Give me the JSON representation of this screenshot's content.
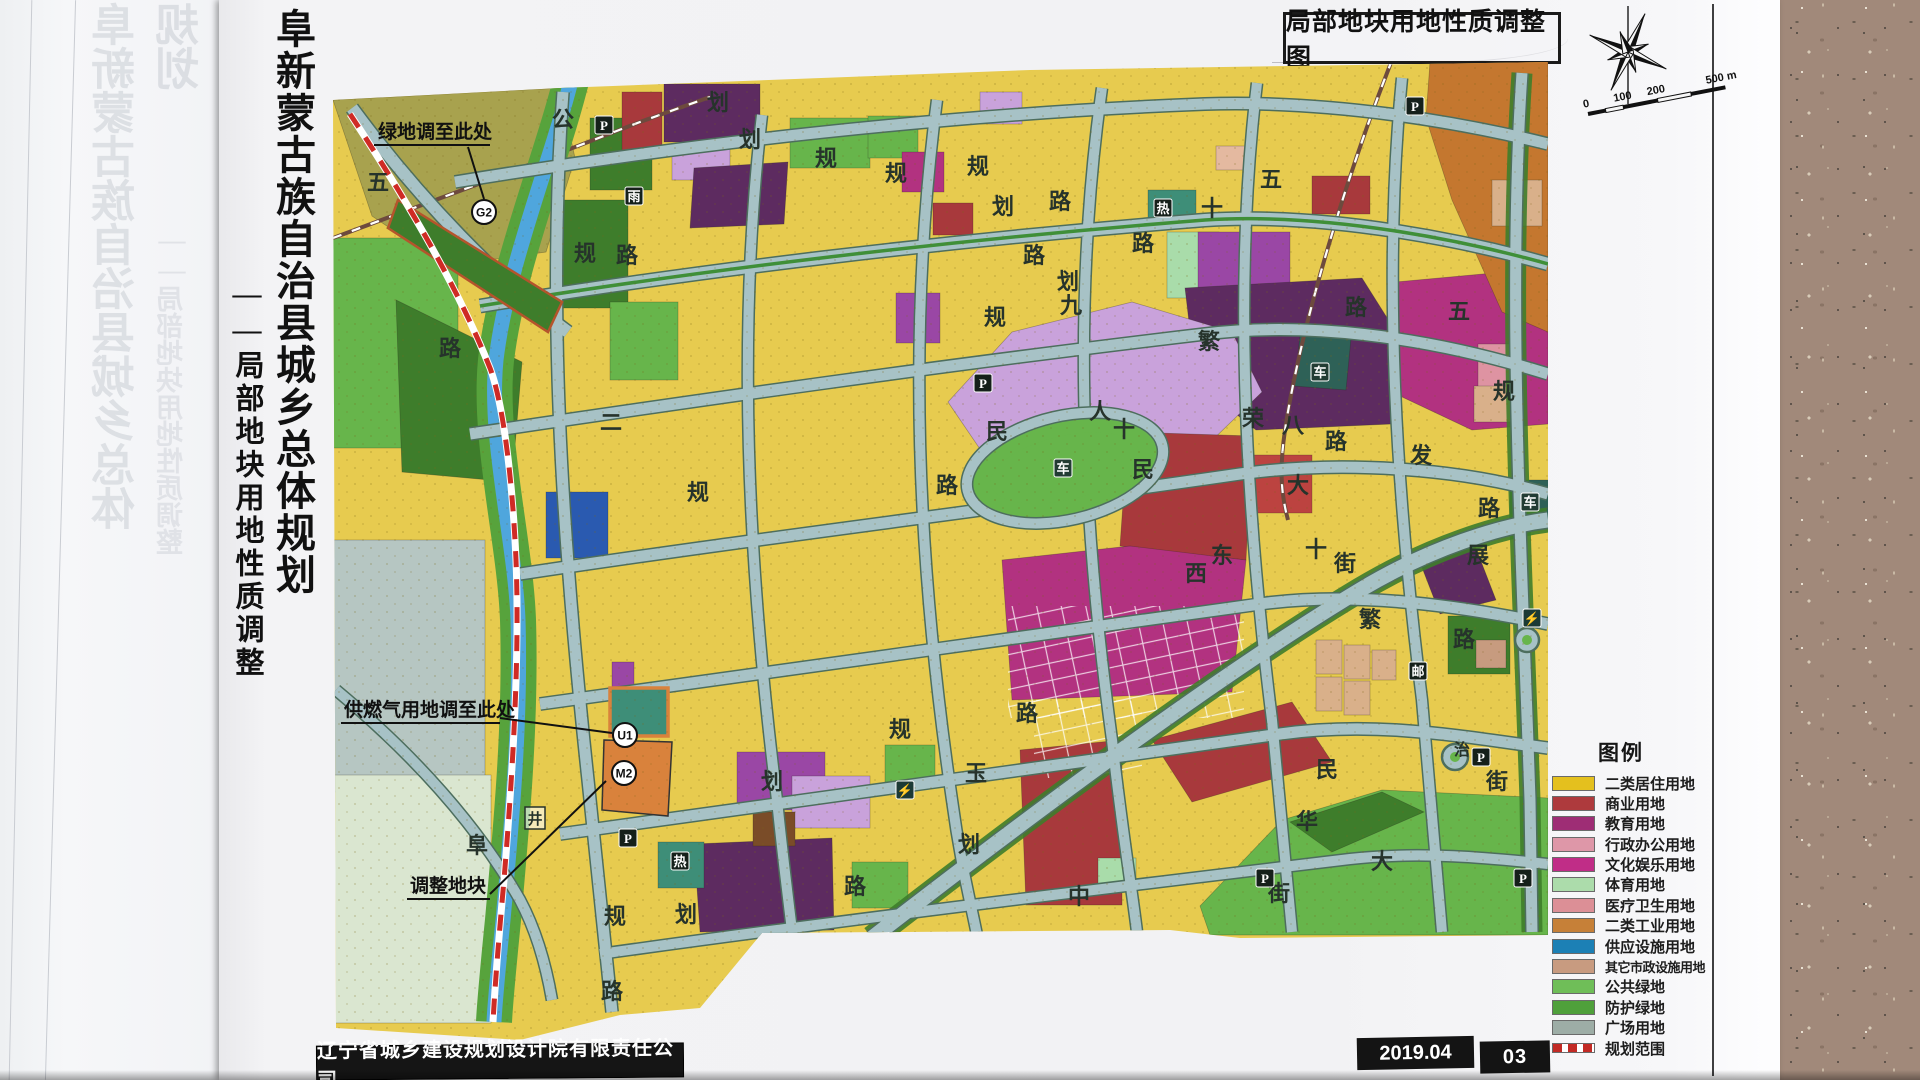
{
  "page": {
    "side_title_main": "阜新蒙古族自治县城乡总体规划",
    "side_title_sub": "——局部地块用地性质调整",
    "ghost_title_main": "阜新蒙古族自治县城乡总体规划",
    "ghost_title_sub": "——局部地块用地性质调整",
    "map_sheet_title": "局部地块用地性质调整图",
    "publisher": "辽宁省城乡建设规划设计院有限责任公司",
    "date": "2019.04",
    "page_number": "03"
  },
  "scale_bar": {
    "labels": [
      "0",
      "100",
      "200",
      "500 m"
    ]
  },
  "annotations": [
    {
      "text": "绿地调至此处",
      "badge": "G2"
    },
    {
      "text": "供燃气用地调至此处",
      "badge": "U1"
    },
    {
      "text": "调整地块",
      "badge": "M2"
    }
  ],
  "legend": {
    "title": "图例",
    "items": [
      {
        "label": "二类居住用地",
        "color": "#e4c01e"
      },
      {
        "label": "商业用地",
        "color": "#ae3a3d"
      },
      {
        "label": "教育用地",
        "color": "#9e2d75"
      },
      {
        "label": "行政办公用地",
        "color": "#de97a8"
      },
      {
        "label": "文化娱乐用地",
        "color": "#c02d87"
      },
      {
        "label": "体育用地",
        "color": "#acdcab"
      },
      {
        "label": "医疗卫生用地",
        "color": "#dc8f96"
      },
      {
        "label": "二类工业用地",
        "color": "#c68038"
      },
      {
        "label": "供应设施用地",
        "color": "#1c80b5"
      },
      {
        "label": "其它市政设施用地",
        "color": "#c89b80",
        "small": true
      },
      {
        "label": "公共绿地",
        "color": "#6fbe58"
      },
      {
        "label": "防护绿地",
        "color": "#4fa03b"
      },
      {
        "label": "广场用地",
        "color": "#9dada6"
      },
      {
        "label": "规划范围",
        "color": "boundary",
        "boundary": true
      }
    ]
  },
  "map": {
    "road_labels": [
      {
        "t": "公",
        "x": 563,
        "y": 127
      },
      {
        "t": "五",
        "x": 378,
        "y": 190
      },
      {
        "t": "路",
        "x": 450,
        "y": 356
      },
      {
        "t": "划",
        "x": 718,
        "y": 110
      },
      {
        "t": "划",
        "x": 750,
        "y": 147
      },
      {
        "t": "规",
        "x": 826,
        "y": 166
      },
      {
        "t": "规",
        "x": 896,
        "y": 181
      },
      {
        "t": "规",
        "x": 978,
        "y": 174
      },
      {
        "t": "划",
        "x": 1003,
        "y": 214
      },
      {
        "t": "路",
        "x": 1060,
        "y": 209
      },
      {
        "t": "规",
        "x": 585,
        "y": 261
      },
      {
        "t": "路",
        "x": 627,
        "y": 263
      },
      {
        "t": "二",
        "x": 611,
        "y": 430
      },
      {
        "t": "规",
        "x": 698,
        "y": 500
      },
      {
        "t": "路",
        "x": 1034,
        "y": 263
      },
      {
        "t": "划",
        "x": 1068,
        "y": 289
      },
      {
        "t": "九",
        "x": 1071,
        "y": 313
      },
      {
        "t": "路",
        "x": 1143,
        "y": 251
      },
      {
        "t": "规",
        "x": 995,
        "y": 325
      },
      {
        "t": "十",
        "x": 1212,
        "y": 216
      },
      {
        "t": "五",
        "x": 1271,
        "y": 187
      },
      {
        "t": "繁",
        "x": 1209,
        "y": 349
      },
      {
        "t": "荣",
        "x": 1253,
        "y": 426
      },
      {
        "t": "八",
        "x": 1293,
        "y": 433
      },
      {
        "t": "路",
        "x": 1336,
        "y": 449
      },
      {
        "t": "规",
        "x": 1504,
        "y": 399
      },
      {
        "t": "五",
        "x": 1459,
        "y": 319
      },
      {
        "t": "路",
        "x": 1356,
        "y": 315
      },
      {
        "t": "民",
        "x": 997,
        "y": 439
      },
      {
        "t": "人",
        "x": 1100,
        "y": 419
      },
      {
        "t": "十",
        "x": 1124,
        "y": 437
      },
      {
        "t": "民",
        "x": 1143,
        "y": 477
      },
      {
        "t": "路",
        "x": 947,
        "y": 493
      },
      {
        "t": "大",
        "x": 1298,
        "y": 493
      },
      {
        "t": "十",
        "x": 1316,
        "y": 557
      },
      {
        "t": "街",
        "x": 1345,
        "y": 571
      },
      {
        "t": "发",
        "x": 1421,
        "y": 463
      },
      {
        "t": "路",
        "x": 1489,
        "y": 516
      },
      {
        "t": "展",
        "x": 1478,
        "y": 563
      },
      {
        "t": "西",
        "x": 1196,
        "y": 581
      },
      {
        "t": "东",
        "x": 1222,
        "y": 563
      },
      {
        "t": "繁",
        "x": 1370,
        "y": 627
      },
      {
        "t": "路",
        "x": 1464,
        "y": 647
      },
      {
        "t": "治",
        "x": 1462,
        "y": 755,
        "s": 16
      },
      {
        "t": "街",
        "x": 1497,
        "y": 789
      },
      {
        "t": "民",
        "x": 1327,
        "y": 777
      },
      {
        "t": "华",
        "x": 1307,
        "y": 829
      },
      {
        "t": "大",
        "x": 1382,
        "y": 869
      },
      {
        "t": "规",
        "x": 900,
        "y": 737
      },
      {
        "t": "路",
        "x": 1027,
        "y": 721
      },
      {
        "t": "玉",
        "x": 976,
        "y": 781
      },
      {
        "t": "划",
        "x": 969,
        "y": 852
      },
      {
        "t": "路",
        "x": 855,
        "y": 894
      },
      {
        "t": "划",
        "x": 772,
        "y": 789
      },
      {
        "t": "中",
        "x": 1079,
        "y": 904
      },
      {
        "t": "街",
        "x": 1279,
        "y": 901
      },
      {
        "t": "规",
        "x": 615,
        "y": 924
      },
      {
        "t": "划",
        "x": 686,
        "y": 922
      },
      {
        "t": "阜",
        "x": 477,
        "y": 853
      },
      {
        "t": "路",
        "x": 612,
        "y": 999
      }
    ],
    "icons": [
      {
        "g": "P",
        "x": 604,
        "y": 125
      },
      {
        "g": "P",
        "x": 983,
        "y": 383
      },
      {
        "g": "P",
        "x": 628,
        "y": 838
      },
      {
        "g": "P",
        "x": 1265,
        "y": 878
      },
      {
        "g": "P",
        "x": 1523,
        "y": 878
      },
      {
        "g": "P",
        "x": 1481,
        "y": 757
      },
      {
        "g": "P",
        "x": 1415,
        "y": 106
      },
      {
        "g": "雨",
        "x": 634,
        "y": 196
      },
      {
        "g": "热",
        "x": 680,
        "y": 861
      },
      {
        "g": "热",
        "x": 1163,
        "y": 208
      },
      {
        "g": "邮",
        "x": 1418,
        "y": 671
      },
      {
        "g": "⚡",
        "x": 905,
        "y": 790,
        "bg": "#1c3a35"
      },
      {
        "g": "⚡",
        "x": 1532,
        "y": 618,
        "bg": "#1c3a35"
      },
      {
        "g": "车",
        "x": 1063,
        "y": 468,
        "bg": "#223c33"
      },
      {
        "g": "车",
        "x": 1320,
        "y": 372,
        "bg": "#223c33"
      },
      {
        "g": "车",
        "x": 1530,
        "y": 502,
        "bg": "#223c33"
      }
    ],
    "badges": [
      {
        "t": "G2",
        "x": 484,
        "y": 212
      },
      {
        "t": "U1",
        "x": 625,
        "y": 735
      },
      {
        "t": "M2",
        "x": 624,
        "y": 773
      }
    ],
    "boxed_labels": [
      {
        "t": "井",
        "x": 535,
        "y": 818
      }
    ]
  },
  "colors": {
    "yellow": "#e7cb4f",
    "red": "#a8393c",
    "red2": "#bc4340",
    "eggplant": "#5d2b60",
    "magenta": "#b23280",
    "purple": "#9a47a5",
    "lilac": "#c9a2db",
    "pink": "#de93a2",
    "peach": "#e4b9a0",
    "ltgreen": "#a9dcaa",
    "green": "#67b54b",
    "dkgreen": "#3e7d2b",
    "teal": "#3e8e78",
    "dkteal": "#2e6157",
    "blue": "#2a5ab0",
    "orange": "#d9823c",
    "ochre": "#c4772f",
    "brown": "#7a4c28",
    "tan": "#d9b08a",
    "tan2": "#c79b7f",
    "olive": "#a8a24e",
    "grayblue": "#b6c6c2",
    "palegreen": "#dae6d0",
    "road": "#a7c2c6",
    "roadEdge": "#4d6e5e",
    "river": "#4fa6dd",
    "bank": "#57a33c",
    "boundary": "#cf2b25",
    "rail": "#6d4a3e",
    "label": "#26332b"
  }
}
